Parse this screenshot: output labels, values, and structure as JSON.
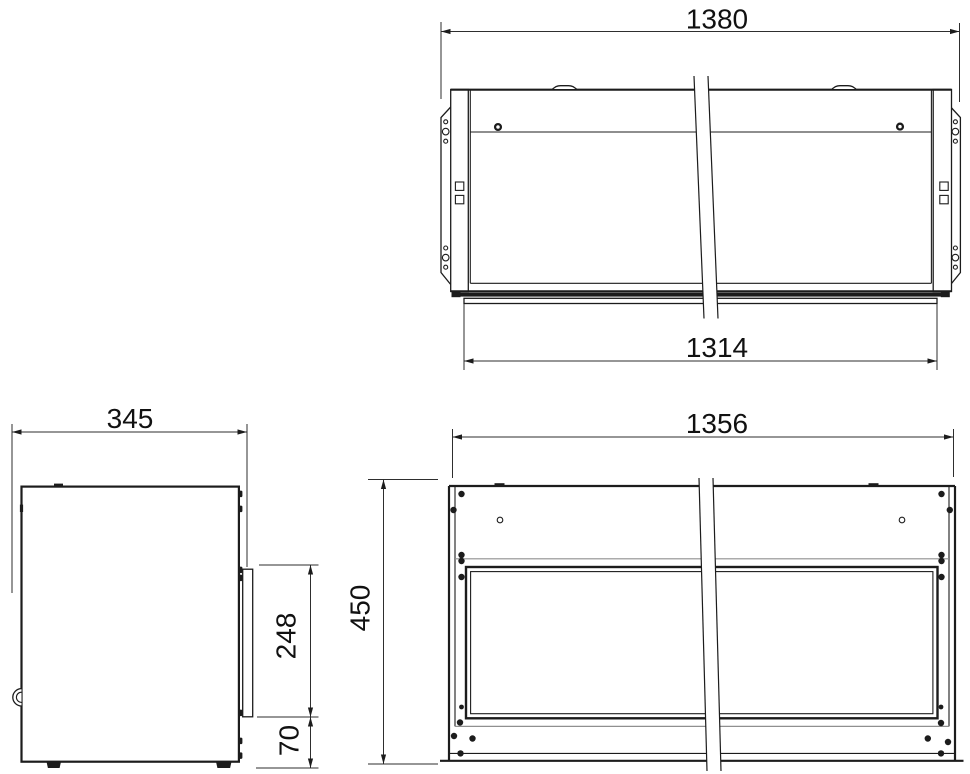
{
  "drawing": {
    "kind": "three-view dimensioned technical drawing of a wall-mounted enclosure",
    "line_color": "#1c1c1c",
    "background_color": "#ffffff"
  },
  "views": {
    "top": {
      "dims": {
        "overall_width": "1380",
        "base_width": "1314"
      }
    },
    "side": {
      "dims": {
        "depth": "345",
        "bracket_height": "248",
        "bottom_offset": "70"
      }
    },
    "front": {
      "dims": {
        "body_width": "1356",
        "height": "450"
      }
    }
  }
}
